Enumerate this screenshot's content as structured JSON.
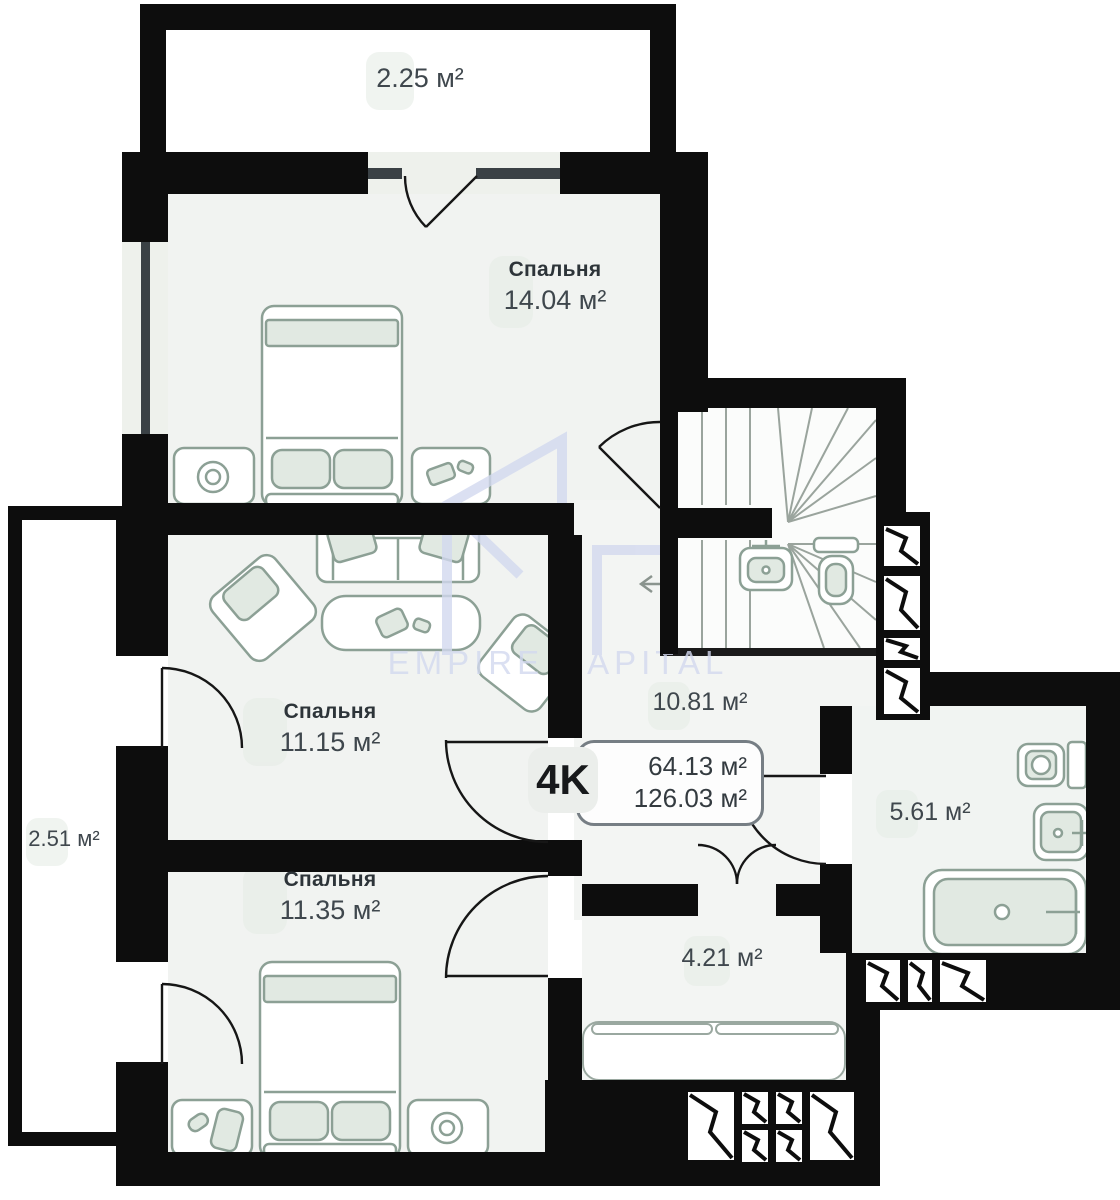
{
  "plan": {
    "watermark": "EMPIRE CAPITAL",
    "badge": {
      "type": "4K",
      "area_living": "64.13 м²",
      "area_total": "126.03 м²"
    },
    "rooms": {
      "balcony_top": {
        "area": "2.25 м²"
      },
      "bedroom_top": {
        "name": "Спальня",
        "area": "14.04 м²"
      },
      "bedroom_middle": {
        "name": "Спальня",
        "area": "11.15 м²"
      },
      "bedroom_bottom": {
        "name": "Спальня",
        "area": "11.35 м²"
      },
      "balcony_left": {
        "area": "2.51 м²"
      },
      "hall": {
        "area": "10.81 м²"
      },
      "bathroom": {
        "area": "5.61 м²"
      },
      "entry": {
        "area": "4.21 м²"
      }
    },
    "colors": {
      "wall": "#0d0d0d",
      "room_fill": "#f1f3f1",
      "furniture_line": "#8ca095",
      "furniture_fill": "#e1e9e2",
      "watermark": "#d3d9ef",
      "label_text": "#3f474d",
      "room_name_text": "#2d3439"
    }
  }
}
